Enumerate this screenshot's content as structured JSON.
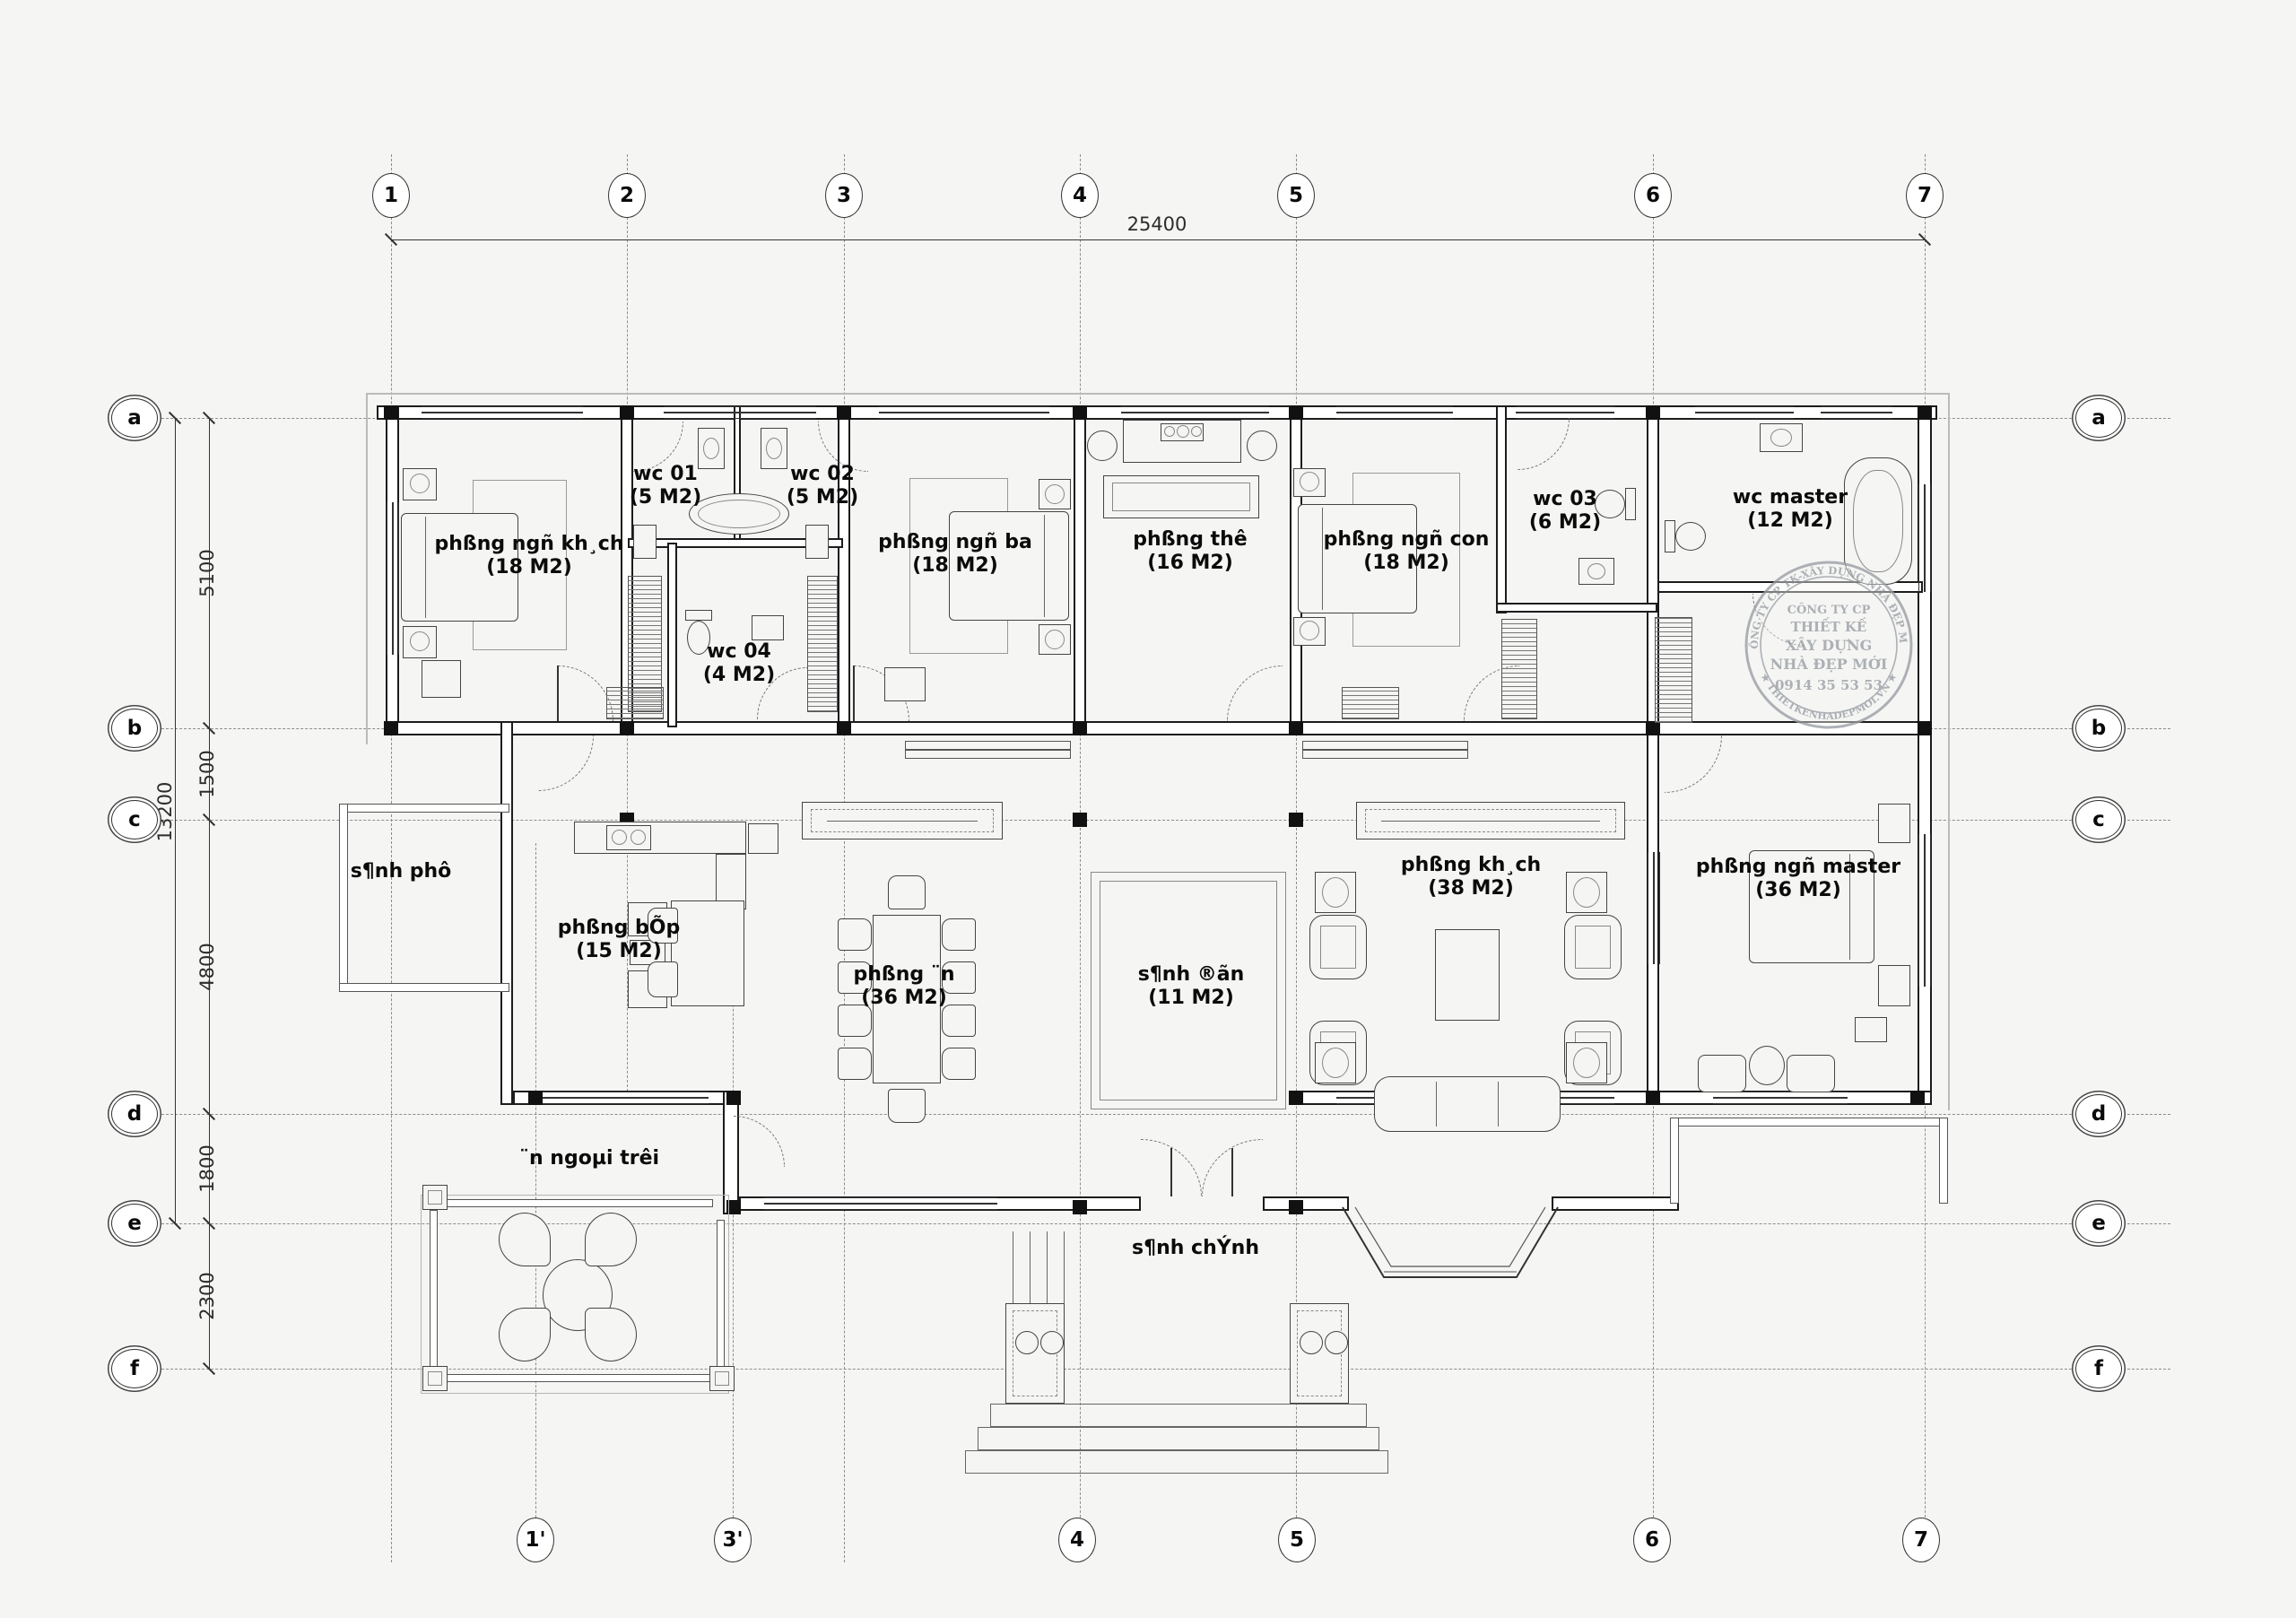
{
  "dims": {
    "overall_width": "25400",
    "overall_height": "13200",
    "segments": [
      "5100",
      "1500",
      "4800",
      "1800",
      "2300"
    ]
  },
  "grid": {
    "top": [
      "1",
      "2",
      "3",
      "4",
      "5",
      "6",
      "7"
    ],
    "bottom": [
      "1'",
      "3'",
      "4",
      "5",
      "6",
      "7"
    ],
    "rows": [
      "a",
      "b",
      "c",
      "d",
      "e",
      "f"
    ]
  },
  "rooms": {
    "bed1": {
      "name": "phßng ngñ kh¸ch",
      "area": "(18 M2)"
    },
    "wc01": {
      "name": "wc 01",
      "area": "(5 M2)"
    },
    "wc02": {
      "name": "wc 02",
      "area": "(5 M2)"
    },
    "wc04": {
      "name": "wc 04",
      "area": "(4 M2)"
    },
    "bed_ba": {
      "name": "phßng ngñ ba",
      "area": "(18 M2)"
    },
    "tho": {
      "name": "phßng thê",
      "area": "(16 M2)"
    },
    "bed_con": {
      "name": "phßng ngñ con",
      "area": "(18 M2)"
    },
    "wc03": {
      "name": "wc 03",
      "area": "(6 M2)"
    },
    "wc_master": {
      "name": "wc master",
      "area": "(12 M2)"
    },
    "sanh_phu": {
      "name": "s¶nh phô"
    },
    "bep": {
      "name": "phßng bÕp",
      "area": "(15 M2)"
    },
    "an": {
      "name": "phßng ¨n",
      "area": "(36 M2)"
    },
    "sanh_don": {
      "name": "s¶nh ®ãn",
      "area": "(11 M2)"
    },
    "khach": {
      "name": "phßng kh¸ch",
      "area": "(38 M2)"
    },
    "master": {
      "name": "phßng ngñ master",
      "area": "(36 M2)"
    },
    "an_ngoai": {
      "name": "¨n ngoµi trêi"
    },
    "sanh_chinh": {
      "name": "s¶nh chÝnh"
    }
  },
  "stamp": {
    "arc_top": "CÔNG TY CP TK-XÂY DỰNG NHÀ ĐẸP MỚI",
    "arc_bottom": "★ THIETKENHADEPMOI.VN ★",
    "line1": "CÔNG TY CP",
    "line2": "THIẾT KẾ",
    "line3": "XÂY DỰNG",
    "line4": "NHÀ ĐẸP MỚI",
    "phone": "0914 35 53 53"
  }
}
